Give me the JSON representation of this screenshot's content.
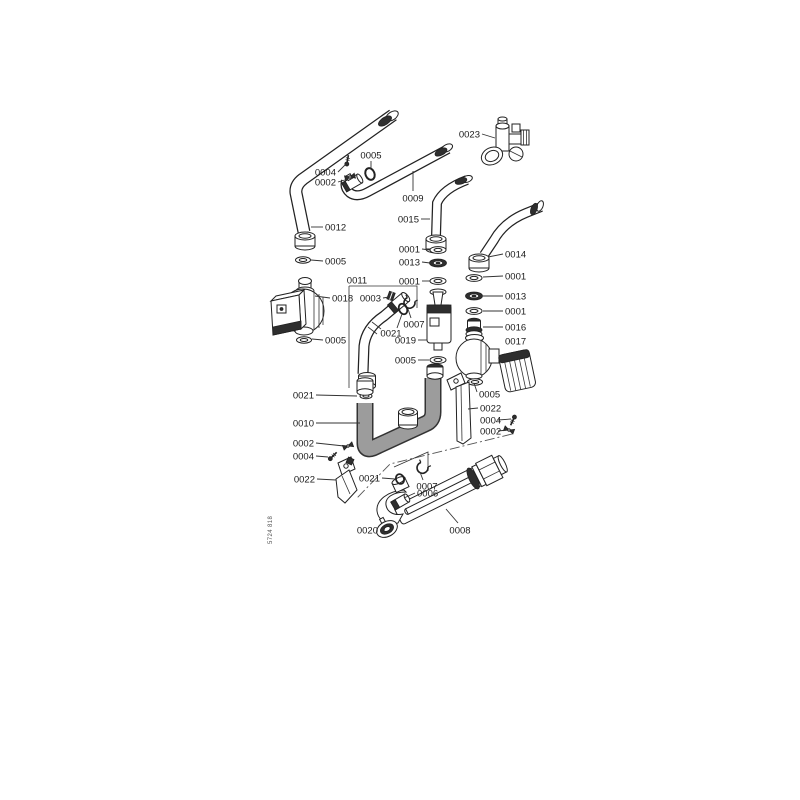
{
  "diagram": {
    "document_number": "5724 818",
    "colors": {
      "background": "#ffffff",
      "line": "#222222",
      "dark_fill": "#2e2e2e",
      "insulation_gray": "#9c9c9c",
      "label_text": "#1a1a1a"
    },
    "part_numbers_visible": [
      "0001",
      "0002",
      "0003",
      "0004",
      "0005",
      "0006",
      "0007",
      "0008",
      "0009",
      "0010",
      "0011",
      "0012",
      "0013",
      "0014",
      "0015",
      "0016",
      "0017",
      "0018",
      "0019",
      "0020",
      "0021",
      "0022",
      "0023"
    ],
    "labels": [
      {
        "text": "0023",
        "x": 480,
        "y": 134,
        "anchor": "end",
        "leader": [
          482,
          134,
          495,
          138
        ]
      },
      {
        "text": "0005",
        "x": 371,
        "y": 155,
        "anchor": "middle",
        "leader": [
          371,
          161,
          371,
          169
        ]
      },
      {
        "text": "0004",
        "x": 336,
        "y": 172,
        "anchor": "end",
        "leader": [
          338,
          172,
          346,
          164
        ]
      },
      {
        "text": "0002",
        "x": 336,
        "y": 182,
        "anchor": "end",
        "leader": [
          338,
          182,
          348,
          179
        ]
      },
      {
        "text": "0012",
        "x": 325,
        "y": 227,
        "anchor": "start",
        "leader": [
          323,
          227,
          311,
          227
        ]
      },
      {
        "text": "0009",
        "x": 413,
        "y": 198,
        "anchor": "middle",
        "leader": [
          413,
          191,
          413,
          171
        ]
      },
      {
        "text": "0015",
        "x": 419,
        "y": 219,
        "anchor": "end",
        "leader": [
          421,
          219,
          430,
          219
        ]
      },
      {
        "text": "0014",
        "x": 505,
        "y": 254,
        "anchor": "start",
        "leader": [
          503,
          254,
          488,
          257
        ]
      },
      {
        "text": "0001",
        "x": 420,
        "y": 249,
        "anchor": "end",
        "leader": [
          422,
          249,
          430,
          250
        ]
      },
      {
        "text": "0013",
        "x": 420,
        "y": 262,
        "anchor": "end",
        "leader": [
          422,
          262,
          430,
          263
        ]
      },
      {
        "text": "0001",
        "x": 420,
        "y": 281,
        "anchor": "end",
        "leader": [
          422,
          281,
          430,
          281
        ]
      },
      {
        "text": "0005",
        "x": 325,
        "y": 261,
        "anchor": "start",
        "leader": [
          323,
          261,
          311,
          260
        ]
      },
      {
        "text": "0018",
        "x": 332,
        "y": 298,
        "anchor": "start",
        "leader": [
          330,
          298,
          315,
          296
        ]
      },
      {
        "text": "0005",
        "x": 325,
        "y": 340,
        "anchor": "start",
        "leader": [
          323,
          340,
          312,
          339
        ]
      },
      {
        "text": "0011",
        "x": 357,
        "y": 280,
        "anchor": "middle"
      },
      {
        "text": "0003",
        "x": 381,
        "y": 298,
        "anchor": "end",
        "leader": [
          383,
          298,
          389,
          297
        ]
      },
      {
        "text": "0007",
        "x": 414,
        "y": 324,
        "anchor": "middle",
        "leader": [
          411,
          318,
          408,
          309
        ]
      },
      {
        "text": "0021",
        "x": 391,
        "y": 333,
        "anchor": "middle",
        "leader": [
          397,
          328,
          402,
          314
        ]
      },
      {
        "text": "0019",
        "x": 416,
        "y": 340,
        "anchor": "end",
        "leader": [
          418,
          340,
          427,
          340
        ]
      },
      {
        "text": "0005",
        "x": 416,
        "y": 360,
        "anchor": "end",
        "leader": [
          418,
          360,
          429,
          360
        ]
      },
      {
        "text": "0001",
        "x": 505,
        "y": 276,
        "anchor": "start",
        "leader": [
          503,
          276,
          483,
          277
        ]
      },
      {
        "text": "0013",
        "x": 505,
        "y": 296,
        "anchor": "start",
        "leader": [
          503,
          296,
          483,
          296
        ]
      },
      {
        "text": "0001",
        "x": 505,
        "y": 311,
        "anchor": "start",
        "leader": [
          503,
          311,
          483,
          311
        ]
      },
      {
        "text": "0016",
        "x": 505,
        "y": 327,
        "anchor": "start",
        "leader": [
          503,
          327,
          483,
          327
        ]
      },
      {
        "text": "0017",
        "x": 505,
        "y": 341,
        "anchor": "start"
      },
      {
        "text": "0021",
        "x": 314,
        "y": 395,
        "anchor": "end",
        "leader": [
          316,
          395,
          357,
          396
        ]
      },
      {
        "text": "0010",
        "x": 314,
        "y": 423,
        "anchor": "end",
        "leader": [
          316,
          423,
          360,
          423
        ]
      },
      {
        "text": "0002",
        "x": 314,
        "y": 443,
        "anchor": "end",
        "leader": [
          316,
          443,
          344,
          446
        ]
      },
      {
        "text": "0004",
        "x": 314,
        "y": 456,
        "anchor": "end",
        "leader": [
          316,
          456,
          328,
          457
        ]
      },
      {
        "text": "0022",
        "x": 315,
        "y": 479,
        "anchor": "end",
        "leader": [
          317,
          479,
          336,
          480
        ]
      },
      {
        "text": "0005",
        "x": 479,
        "y": 394,
        "anchor": "start",
        "leader": [
          477,
          392,
          474,
          383
        ]
      },
      {
        "text": "0022",
        "x": 480,
        "y": 408,
        "anchor": "start",
        "leader": [
          478,
          408,
          468,
          409
        ]
      },
      {
        "text": "0004",
        "x": 480,
        "y": 420,
        "anchor": "start",
        "leader": [
          498,
          420,
          511,
          419
        ]
      },
      {
        "text": "0002",
        "x": 480,
        "y": 431,
        "anchor": "start",
        "leader": [
          498,
          431,
          507,
          430
        ]
      },
      {
        "text": "0021",
        "x": 380,
        "y": 478,
        "anchor": "end",
        "leader": [
          382,
          478,
          395,
          479
        ]
      },
      {
        "text": "0007",
        "x": 427,
        "y": 486,
        "anchor": "middle",
        "leader": [
          423,
          480,
          420,
          472
        ]
      },
      {
        "text": "0006",
        "x": 417,
        "y": 493,
        "anchor": "start",
        "leader": [
          415,
          493,
          404,
          498
        ]
      },
      {
        "text": "0020",
        "x": 378,
        "y": 530,
        "anchor": "end",
        "leader": [
          380,
          530,
          385,
          529
        ]
      },
      {
        "text": "0008",
        "x": 460,
        "y": 530,
        "anchor": "middle",
        "leader": [
          458,
          523,
          446,
          509
        ]
      }
    ]
  }
}
